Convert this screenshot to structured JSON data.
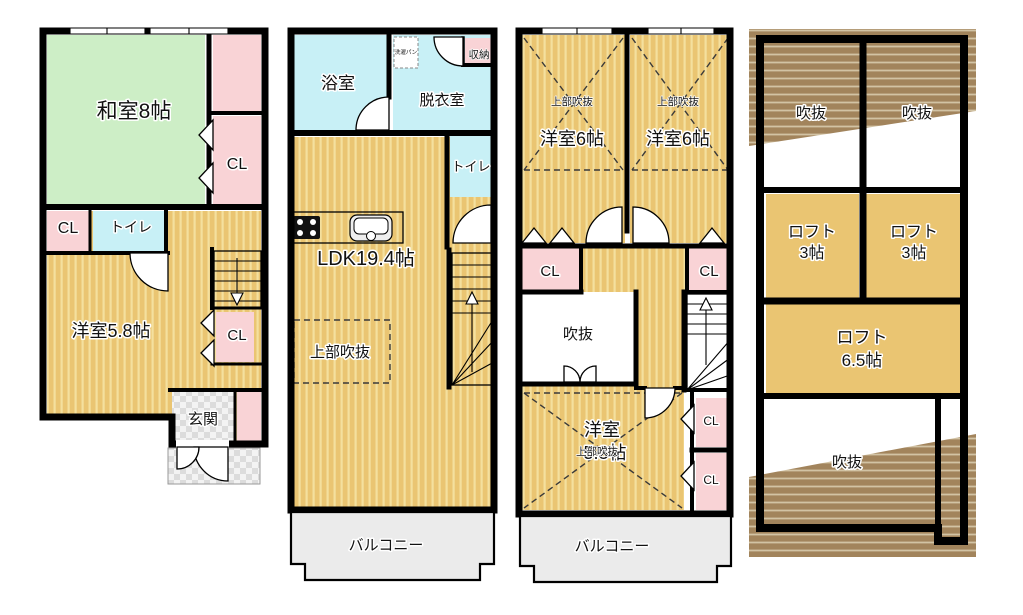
{
  "floor1": {
    "washitsu": "和室8帖",
    "cl_north": "CL",
    "cl_west": "CL",
    "toilet": "トイレ",
    "youshitsu": "洋室5.8帖",
    "cl_center": "CL",
    "genkan": "玄関"
  },
  "floor2": {
    "bathroom": "浴室",
    "washer_pan": "洗濯パン",
    "dressing_room": "脱衣室",
    "storage": "収納",
    "toilet": "トイレ",
    "ldk": "LDK19.4帖",
    "open_ceiling": "上部吹抜",
    "balcony": "バルコニー"
  },
  "floor3": {
    "open_above_left": "上部吹抜",
    "room_left": "洋室6帖",
    "open_above_right": "上部吹抜",
    "room_right": "洋室6帖",
    "cl_west": "CL",
    "cl_east": "CL",
    "void": "吹抜",
    "room_south_name": "洋室",
    "room_south_size": "5.3帖",
    "open_above_south": "上部吹抜",
    "cl_south_upper": "CL",
    "cl_south_lower": "CL",
    "balcony": "バルコニー"
  },
  "floor4": {
    "void_left": "吹抜",
    "void_right": "吹抜",
    "loft_left_name": "ロフト",
    "loft_left_size": "3帖",
    "loft_right_name": "ロフト",
    "loft_right_size": "3帖",
    "loft_main_name": "ロフト",
    "loft_main_size": "6.5帖",
    "void_south": "吹抜"
  },
  "colors": {
    "tatami_green": "#cdeec6",
    "closet_pink": "#f9d3d6",
    "wet_area_cyan": "#c8f0f6",
    "floor_tan": "#eac572",
    "floor_stripe": "#f4e09e",
    "roof_brown": "#a2845c",
    "roof_hatch_line": "#d2c3a4",
    "balcony_gray": "#ebebeb",
    "entrance_gray": "#e0e0e0",
    "wall_black": "#000000"
  }
}
